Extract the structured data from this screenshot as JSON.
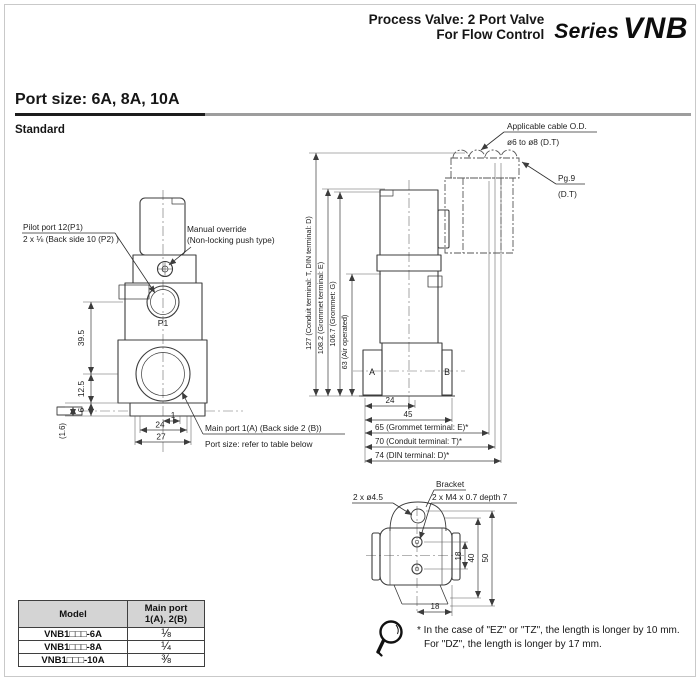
{
  "header": {
    "title_line1": "Process Valve: 2 Port Valve",
    "title_line2": "For Flow Control",
    "series_prefix": "Series",
    "series_name": "VNB"
  },
  "section": {
    "port_size_heading": "Port size: 6A, 8A, 10A",
    "standard_label": "Standard"
  },
  "front_view": {
    "pilot_port_label_line1": "Pilot port 12(P1)",
    "pilot_port_label_line2": "2 x ⅛ (Back side 10 (P2) )",
    "manual_override_label_line1": "Manual override",
    "manual_override_label_line2": "(Non-locking push type)",
    "p1_label": "P1",
    "main_port_label_line1": "Main port 1(A) (Back side 2 (B))",
    "main_port_label_line2": "Port size: refer to table below",
    "dim_39_5": "39.5",
    "dim_12_5": "12.5",
    "dim_6": "6",
    "dim_1_6": "(1.6)",
    "dim_1": "1",
    "dim_24": "24",
    "dim_27": "27"
  },
  "side_view": {
    "cable_label_line1": "Applicable cable O.D.",
    "cable_label_line2": "ø6 to ø8 (D.T)",
    "gland_label_line1": "Pg.9",
    "gland_label_line2": "(D.T)",
    "dim_127": "127  (Conduit terminal: T, DIN terminal: D)",
    "dim_108_2": "108.2 (Grommet terminal: E)",
    "dim_106_7": "106.7 (Grommet: G)",
    "dim_63": "63 (Air operated)",
    "port_a_label": "A",
    "port_b_label": "B",
    "dim_24": "24",
    "dim_45": "45",
    "dim_65": "65 (Grommet terminal: E)*",
    "dim_70": "70 (Conduit terminal: T)*",
    "dim_74": "74 (DIN terminal: D)*"
  },
  "bracket_view": {
    "bracket_label": "Bracket",
    "holes_label": "2 x ø4.5",
    "thread_label": "2 x M4 x 0.7 depth 7",
    "dim_18_vertical": "18",
    "dim_40": "40",
    "dim_50": "50",
    "dim_18_horizontal": "18"
  },
  "table": {
    "col_model": "Model",
    "col_port_line1": "Main port",
    "col_port_line2": "1(A), 2(B)",
    "rows": [
      {
        "model": "VNB1□□□-6A",
        "port": "⅛"
      },
      {
        "model": "VNB1□□□-8A",
        "port": "¼"
      },
      {
        "model": "VNB1□□□-10A",
        "port": "⅜"
      }
    ]
  },
  "note": {
    "line1": "* In the case of \"EZ\" or \"TZ\", the length is longer by 10 mm.",
    "line2": "For \"DZ\", the length is longer by 17 mm."
  }
}
